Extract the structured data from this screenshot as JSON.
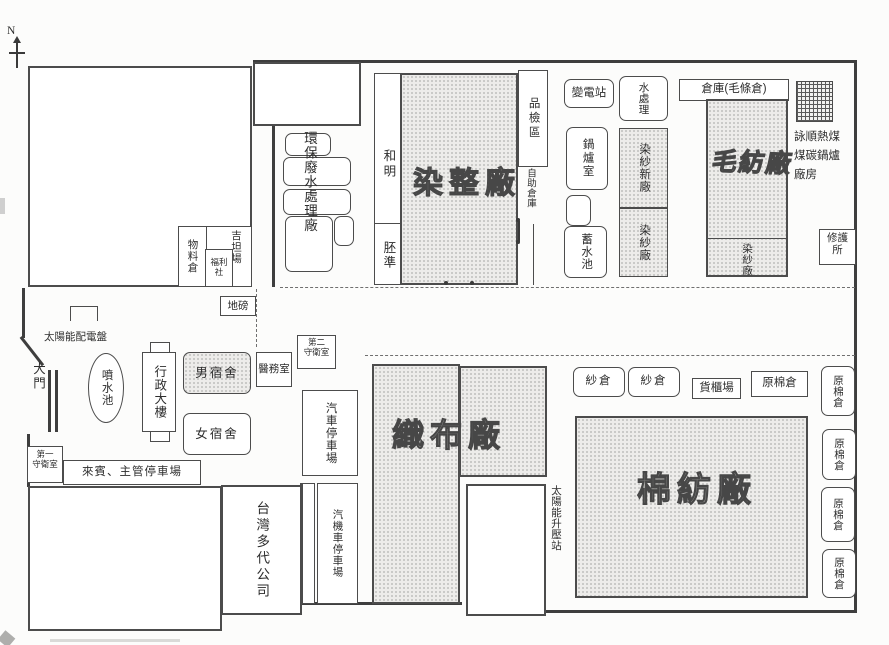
{
  "compass": {
    "label": "N"
  },
  "northwest": {
    "materials_warehouse": "物料倉",
    "welfare_shop": "福利社",
    "yard_label": "吉坦場",
    "weighbridge": "地磅",
    "solar_distribution_panel": "太陽能配電盤"
  },
  "gate_area": {
    "main_gate": "大門",
    "guard_house_1": {
      "line1": "第一",
      "line2": "守衛室"
    },
    "vip_parking": "來賓、主管停車場",
    "taiwan_company": "台灣多代公司"
  },
  "admin_area": {
    "fountain": "噴水池",
    "admin_building": "行政大樓",
    "male_dormitory": "男宿舍",
    "female_dormitory": "女宿舍",
    "medical_room": "醫務室",
    "guard_house_2": {
      "line1": "第二",
      "line2": "守衛室"
    },
    "car_parking": "汽車停車場",
    "car_motorcycle_parking": "汽機車停車場"
  },
  "north_compound": {
    "wastewater_treatment": "環保廢水處理廠",
    "he_ming": "和明",
    "greige_prep": "胚準",
    "dyeing_finishing_mill": "染整廠",
    "inspection_area": "品檢區",
    "self_service_warehouse": "自助倉庫",
    "substation": "變電站",
    "water_treatment": "水處理",
    "warehouse_wool_tops": "倉庫(毛條倉)",
    "boiler_room": "鍋爐室",
    "reservoir": "蓄水池",
    "yarn_dyeing_new_mill": "染紗新廠",
    "yarn_dyeing_mill": "染紗廠",
    "wool_spinning_mill": "毛紡廠",
    "wool_mill_yarn_dyeing": "染紗廠",
    "coal_boiler_house": {
      "line1": "詠順熱煤",
      "line2": "煤碳鍋爐",
      "line3": "廠房"
    },
    "repair_station": {
      "line1": "修護",
      "line2": "所"
    }
  },
  "south_compound": {
    "weaving_mill": "織布廠",
    "solar_boost_station": "太陽能升壓站",
    "yarn_warehouse_1": "紗倉",
    "yarn_warehouse_2": "紗倉",
    "container_yard": "貨櫃場",
    "raw_cotton_warehouse": "原棉倉",
    "cotton_spinning_mill": "棉紡廠",
    "raw_cotton_warehouses_east": [
      "原棉倉",
      "原棉倉",
      "原棉倉",
      "原棉倉"
    ]
  }
}
